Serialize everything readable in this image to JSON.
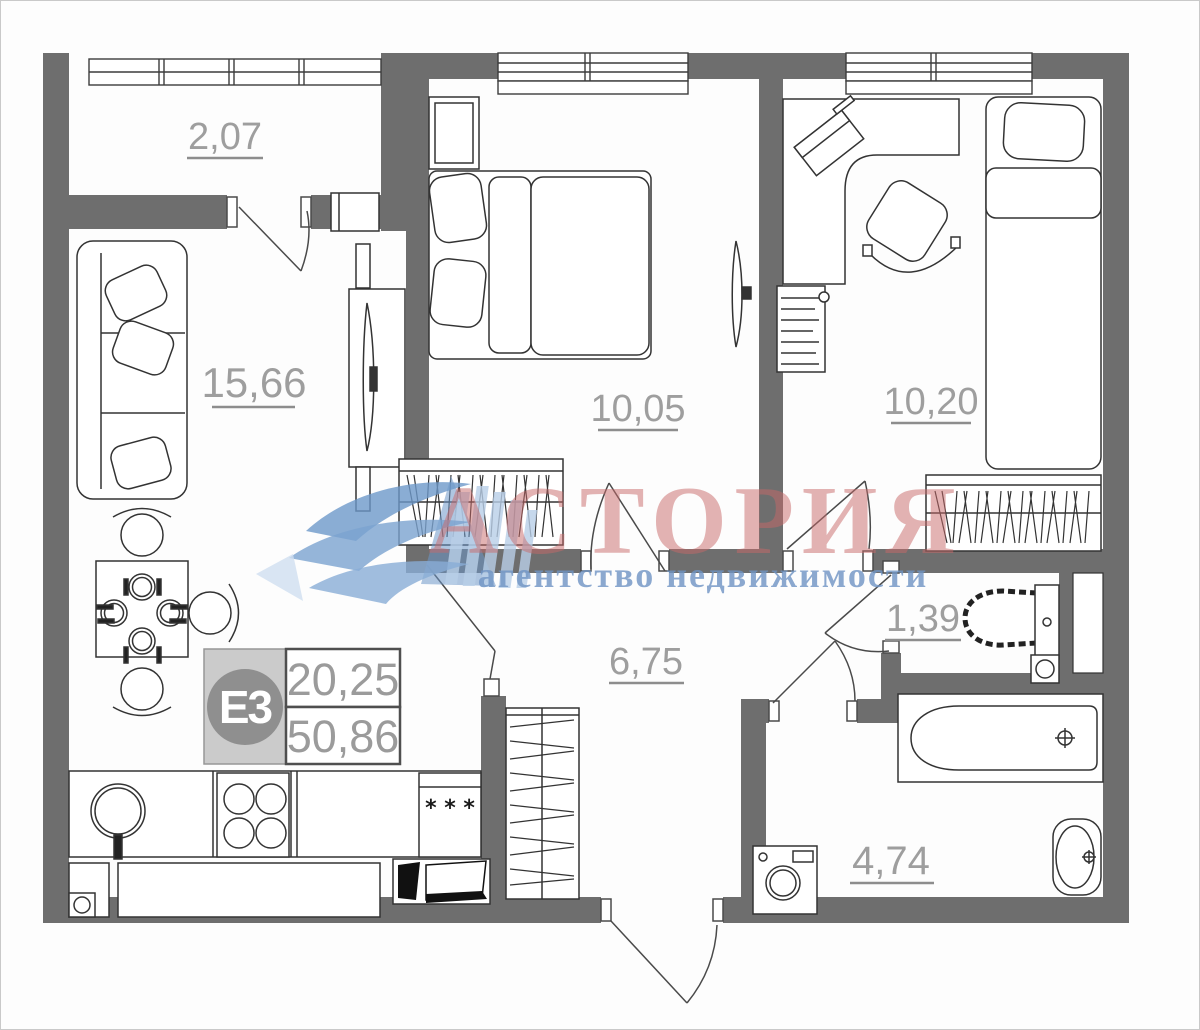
{
  "plan": {
    "rooms": {
      "balcony": "2,07",
      "living": "15,66",
      "bedroom": "10,05",
      "bedroom2": "10,20",
      "hallway": "6,75",
      "wc": "1,39",
      "bathroom": "4,74"
    },
    "badge": {
      "unit_type": "Е3",
      "area_living": "20,25",
      "area_total": "50,86"
    },
    "kitchen": {
      "freezer_stars": "* * *"
    }
  },
  "watermark": {
    "brand": "АСТОРИЯ",
    "tagline": "агентство недвижимости"
  },
  "colors": {
    "wall": "#6e6e6e",
    "line": "#333333",
    "label": "#9e9e9e",
    "watermark_red": "#c96a6a",
    "watermark_blue": "#6f94c4"
  }
}
